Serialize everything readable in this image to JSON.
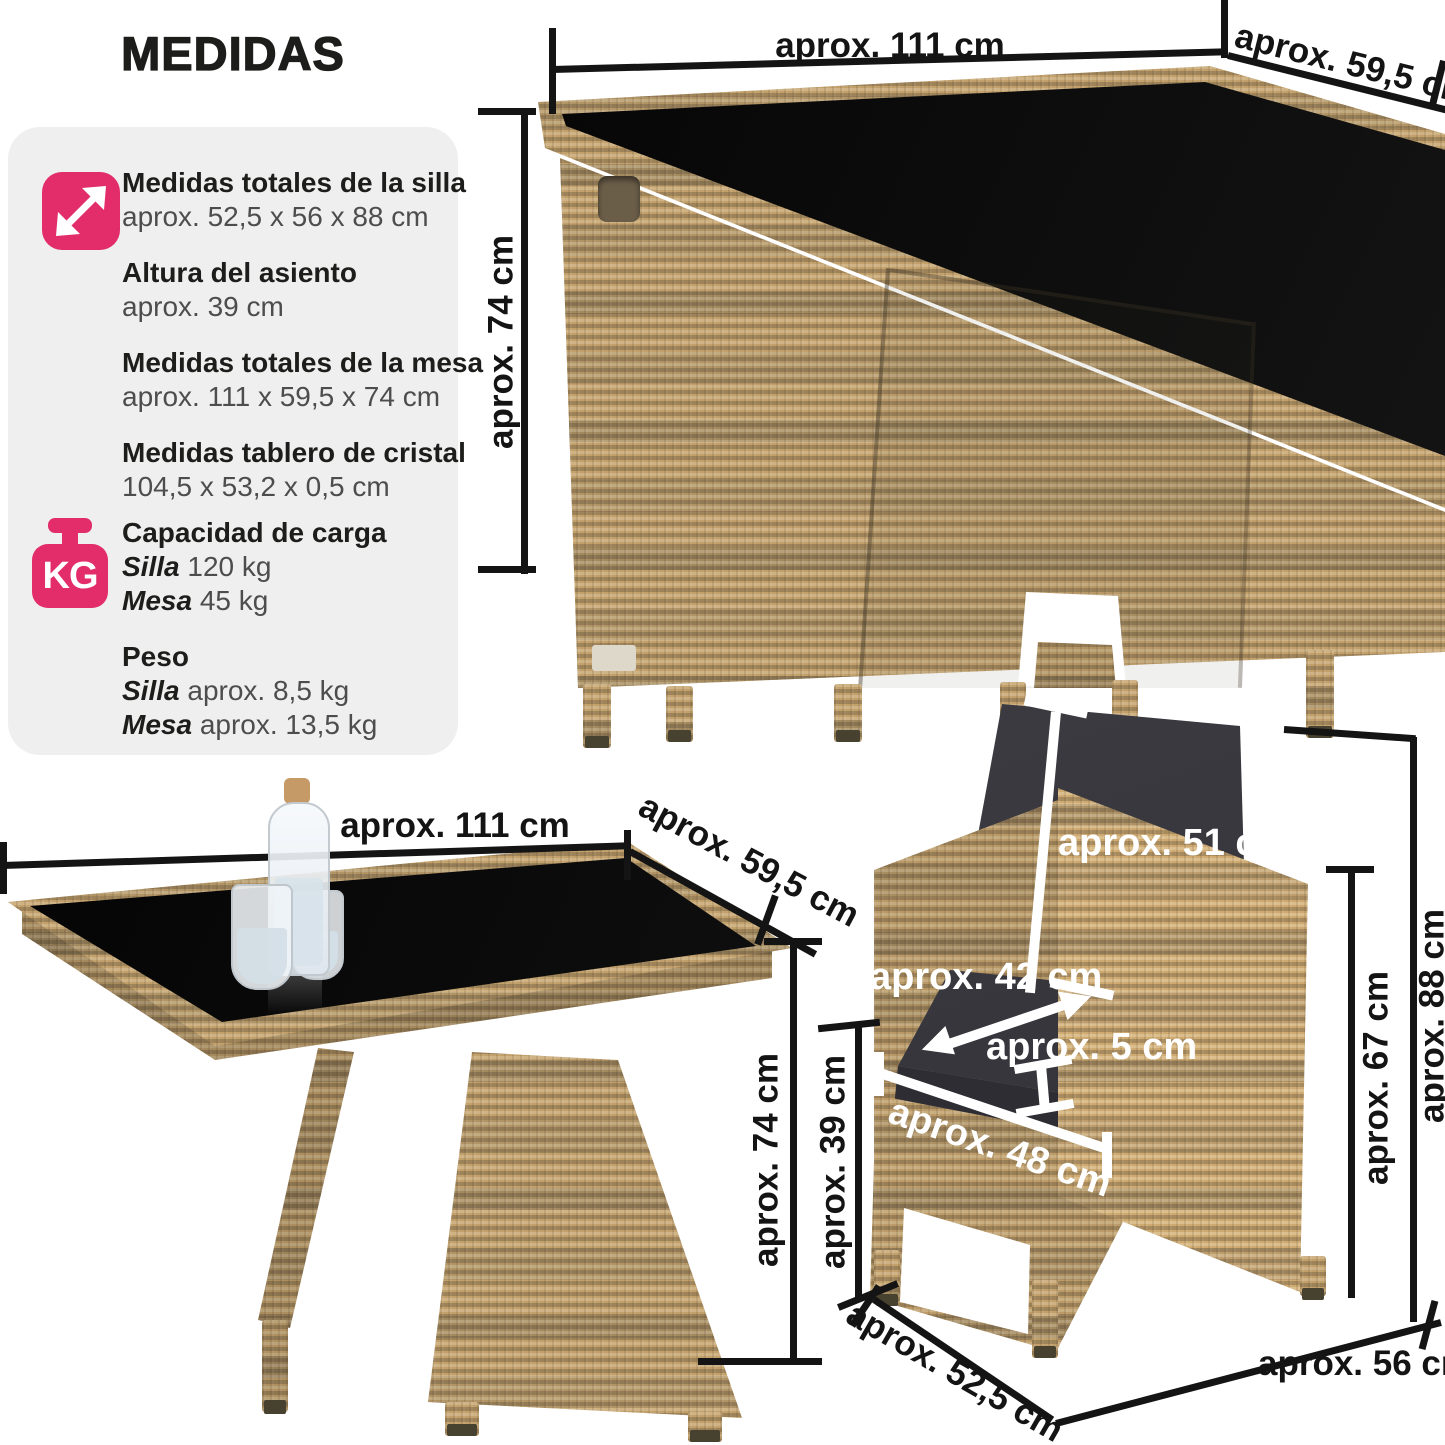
{
  "header": {
    "title": "MEDIDAS"
  },
  "sidebar": {
    "items": [
      {
        "heading": "Medidas totales de la silla",
        "value": "aprox. 52,5 x 56 x 88 cm"
      },
      {
        "heading": "Altura del asiento",
        "value": "aprox. 39 cm"
      },
      {
        "heading": "Medidas totales de la mesa",
        "value": "aprox. 111 x 59,5 x 74 cm"
      },
      {
        "heading": "Medidas tablero de cristal",
        "value": "104,5 x 53,2 x 0,5 cm"
      }
    ],
    "capacity": {
      "heading": "Capacidad de carga",
      "rows": [
        {
          "label": "Silla",
          "value": "120 kg"
        },
        {
          "label": "Mesa",
          "value": "45 kg"
        }
      ]
    },
    "weight": {
      "heading": "Peso",
      "rows": [
        {
          "label": "Silla",
          "value": "aprox. 8,5 kg"
        },
        {
          "label": "Mesa",
          "value": "aprox. 13,5 kg"
        }
      ]
    },
    "kg_icon_text": "KG"
  },
  "figures": {
    "set": {
      "width_label": "aprox. 111 cm",
      "depth_label": "aprox. 59,5 cm",
      "height_label": "aprox. 74 cm"
    },
    "table": {
      "width_label": "aprox. 111 cm",
      "depth_label": "aprox. 59,5 cm",
      "height_label": "aprox. 74 cm"
    },
    "chair": {
      "backrest_label": "aprox. 51 cm",
      "seat_depth_label": "aprox. 42 cm",
      "cushion_thickness_label": "aprox. 5 cm",
      "seat_width_label": "aprox. 48 cm",
      "seat_height_label": "aprox. 39 cm",
      "armrest_height_label": "aprox. 67 cm",
      "total_height_label": "aprox. 88 cm",
      "base_width_label": "aprox. 52,5 cm",
      "base_depth_label": "aprox. 56 cm"
    }
  },
  "colors": {
    "accent_pink": "#e22d6a",
    "panel_gray": "#efefef",
    "text_dark": "#1d1d1b",
    "text_gray": "#4d4d4d",
    "dimension_line": "#141414",
    "white_line": "#ffffff",
    "rattan_base": "#c2a06b",
    "glass_black": "#0b0b0b",
    "cushion_dark": "#3a3a40"
  }
}
